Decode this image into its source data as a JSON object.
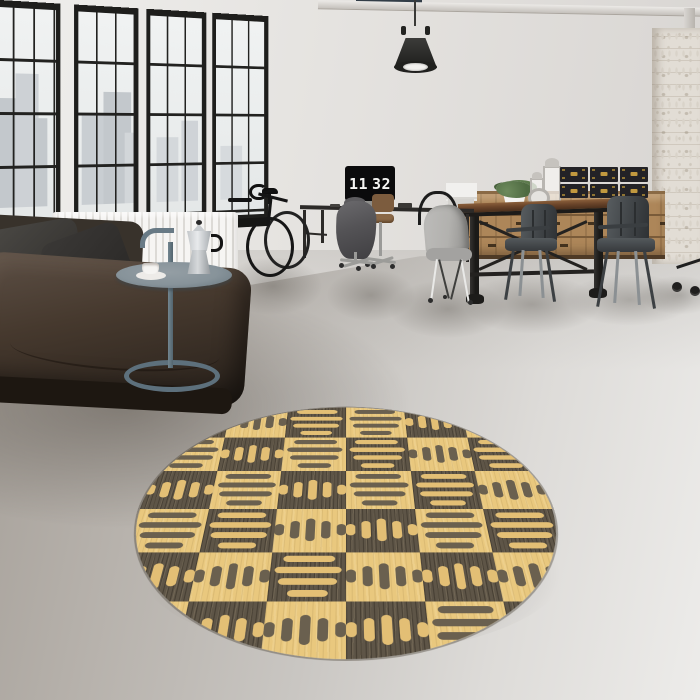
{
  "clock": {
    "hours": "11",
    "minutes": "32"
  },
  "palette": {
    "wall": "#e6e4e1",
    "wall-shade": "#d8d5d2",
    "floor-dark": "#a29c95",
    "floor-mid": "#c9c6c2",
    "floor-light": "#edecea",
    "frame-black": "#1e1e1c",
    "pane": "#eaeded",
    "city": "#c3c8cc",
    "tray": "#87939a",
    "sofa-dark": "#27201a",
    "sofa-mid": "#46392e",
    "sofa-light": "#5d5046",
    "tolix": "#3e4245",
    "chair-gray": "#b2b1ae",
    "box-black": "#232226",
    "box-gold": "#c2993f",
    "column": "#e2ddd5",
    "rug-light": "#e9c87e",
    "rug-dark": "#5e5547",
    "rug-motif-on-light": "#6a604f",
    "rug-motif-on-dark": "#e3bf75"
  },
  "rug": {
    "h_bars": [
      0.7,
      0.88,
      0.78,
      0.52
    ],
    "v_dashes": [
      18,
      28,
      36,
      28,
      18
    ],
    "grid": [
      [
        "dark-h",
        "light-v",
        "dark-h",
        "light-h",
        "dark-v",
        "light-h"
      ],
      [
        "light-h",
        "dark-v",
        "light-h",
        "dark-h",
        "light-v",
        "dark-h"
      ],
      [
        "dark-v",
        "light-h",
        "dark-v",
        "light-h",
        "dark-h",
        "light-v"
      ],
      [
        "light-h",
        "dark-h",
        "light-v",
        "dark-v",
        "light-h",
        "dark-h"
      ],
      [
        "dark-v",
        "light-v",
        "dark-h",
        "light-v",
        "dark-v",
        "light-v"
      ],
      [
        "light-h",
        "dark-v",
        "light-v",
        "dark-v",
        "light-h",
        "dark-v"
      ]
    ]
  }
}
